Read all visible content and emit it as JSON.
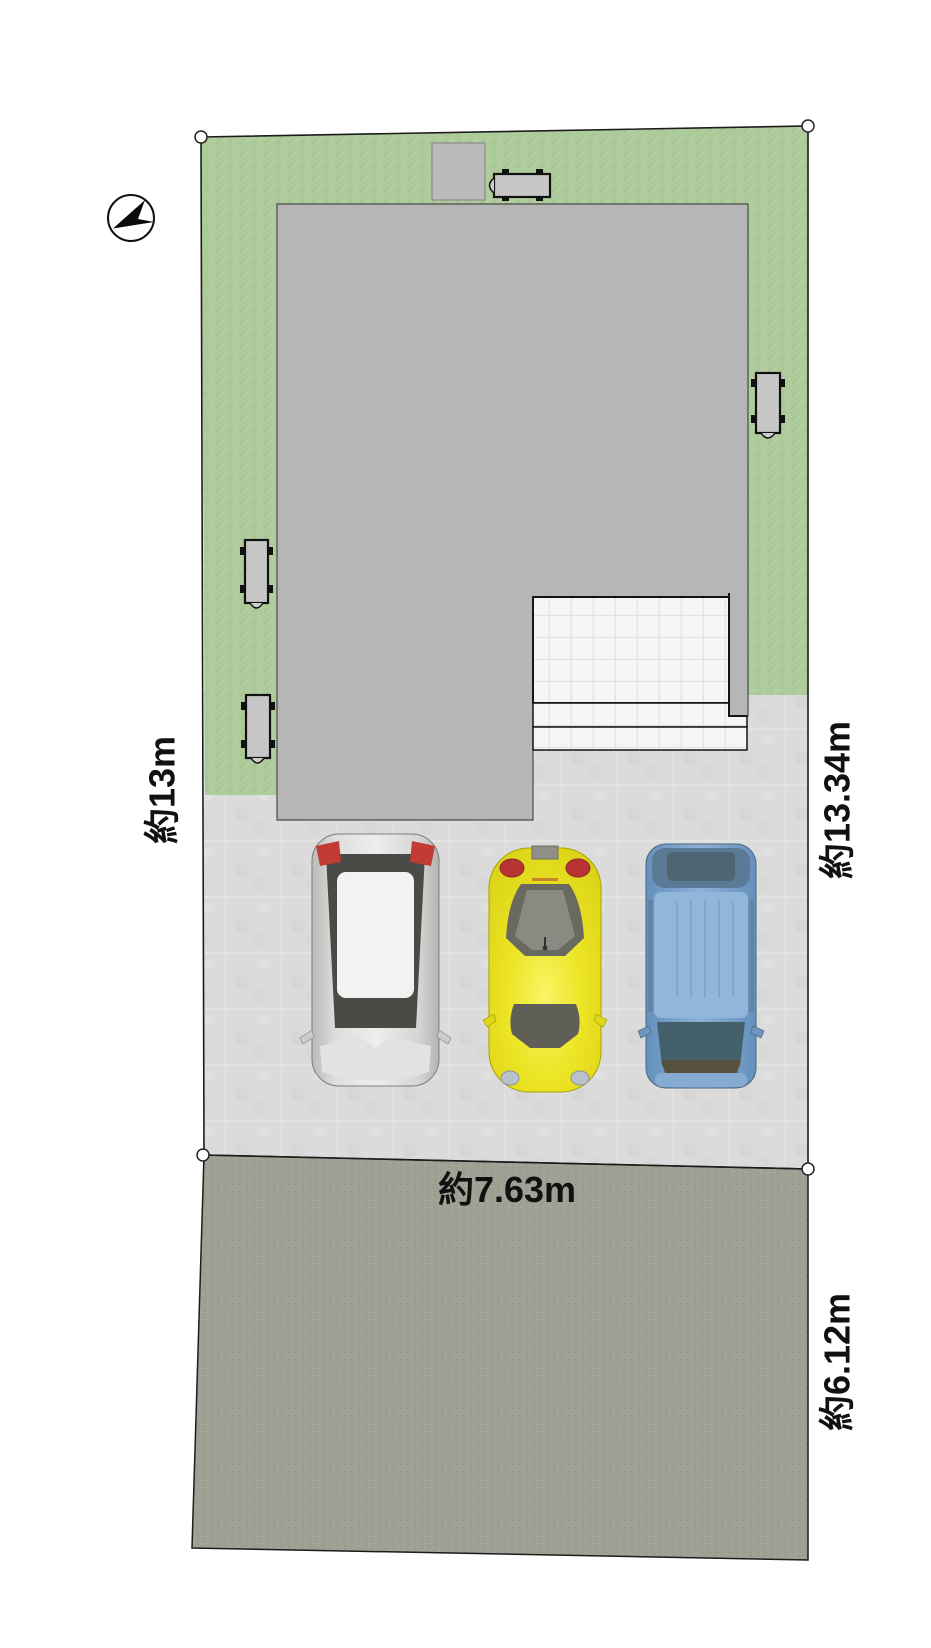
{
  "plan": {
    "type": "real-estate-site-plan",
    "dimensions": {
      "west_boundary": {
        "label": "約13m",
        "meters": 13.0
      },
      "east_boundary": {
        "label": "約13.34m",
        "meters": 13.34
      },
      "frontage": {
        "label": "約7.63m",
        "meters": 7.63
      },
      "road_east_side": {
        "label": "約6.12m",
        "meters": 6.12
      }
    },
    "compass": {
      "icon": "north-arrow",
      "pointing": "lower-left"
    },
    "regions": {
      "lawn_color": "#aecb9b",
      "building_color": "#b6b6b6",
      "parking_color": "#dbdbdb",
      "road_color": "#9da295",
      "entrance_tile_color": "#f6f6f5",
      "outline_color": "#1c1c1c"
    },
    "cars": [
      {
        "name": "white-hatchback",
        "body_color": "#e9e9e6"
      },
      {
        "name": "yellow-coupe",
        "body_color": "#e7df20"
      },
      {
        "name": "blue-minivan",
        "body_color": "#7fa6cf"
      }
    ],
    "equipment": {
      "ac_unit_count": 4,
      "shed_count": 1
    }
  }
}
